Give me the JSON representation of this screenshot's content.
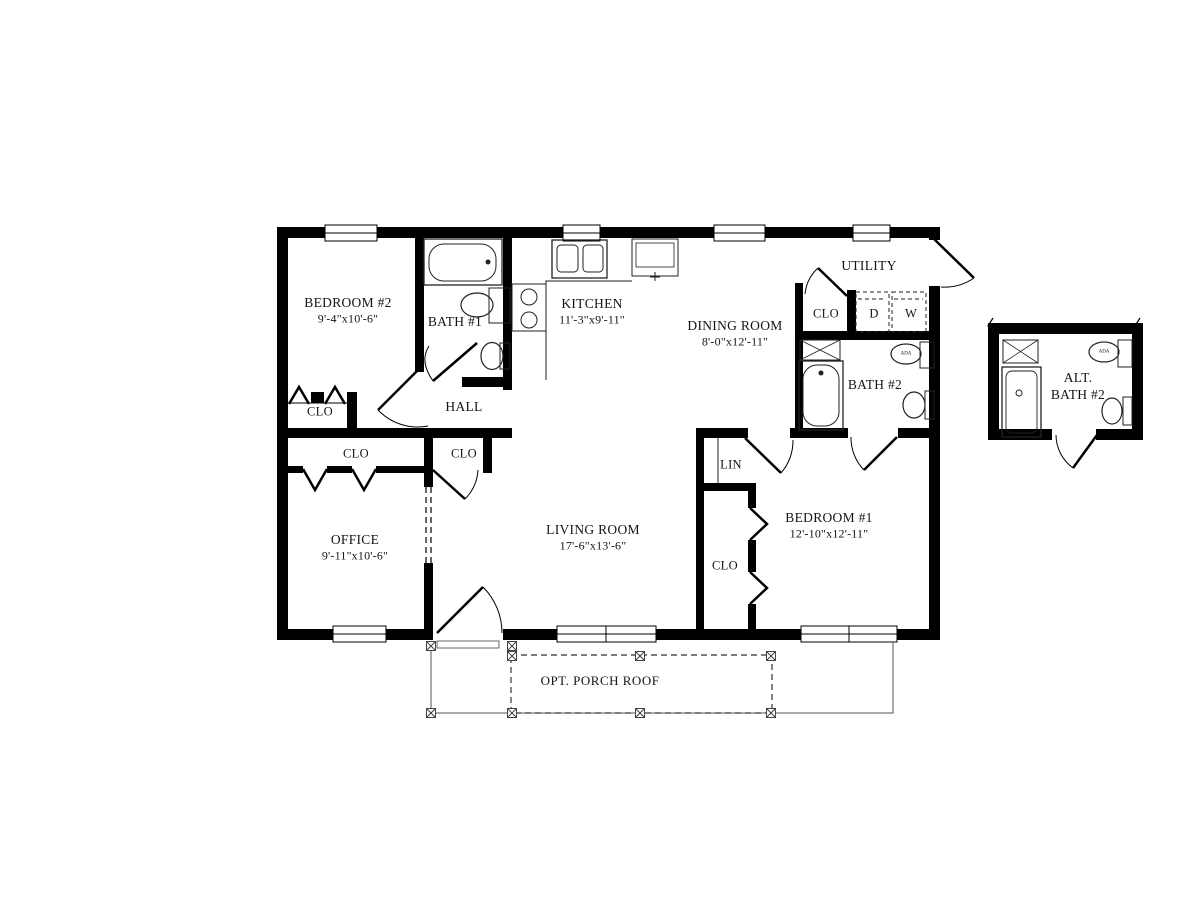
{
  "plan_labels": {
    "bedroom2": {
      "name": "BEDROOM #2",
      "dims": "9'-4\"x10'-6\""
    },
    "bath1": {
      "name": "BATH #1"
    },
    "kitchen": {
      "name": "KITCHEN",
      "dims": "11'-3\"x9'-11\""
    },
    "dining": {
      "name": "DINING ROOM",
      "dims": "8'-0\"x12'-11\""
    },
    "utility": {
      "name": "UTILITY"
    },
    "utility_clo": {
      "name": "CLO"
    },
    "dryer": {
      "name": "D"
    },
    "washer": {
      "name": "W"
    },
    "bath2": {
      "name": "BATH #2"
    },
    "alt_bath": {
      "line1": "ALT.",
      "line2": "BATH #2"
    },
    "bedroom2_clo": {
      "name": "CLO"
    },
    "hall": {
      "name": "HALL"
    },
    "office_clo": {
      "name": "CLO"
    },
    "hall_clo": {
      "name": "CLO"
    },
    "office": {
      "name": "OFFICE",
      "dims": "9'-11\"x10'-6\""
    },
    "living": {
      "name": "LIVING ROOM",
      "dims": "17'-6\"x13'-6\""
    },
    "lin": {
      "name": "LIN"
    },
    "bedroom1_clo": {
      "name": "CLO"
    },
    "bedroom1": {
      "name": "BEDROOM #1",
      "dims": "12'-10\"x12'-11\""
    },
    "porch": {
      "name": "OPT. PORCH ROOF"
    },
    "ada_bath2": {
      "name": "ADA"
    },
    "ada_altbath": {
      "name": "ADA"
    }
  },
  "colors": {
    "wall": "#000000",
    "background": "#ffffff",
    "thin_line": "#222222"
  }
}
